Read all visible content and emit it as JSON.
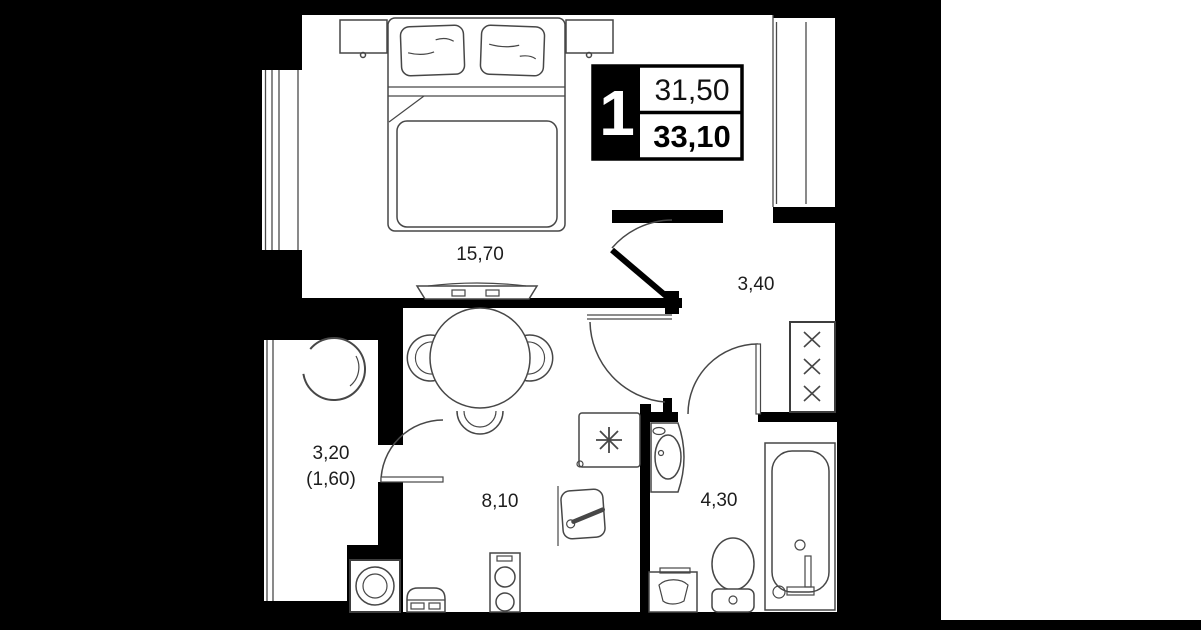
{
  "legend": {
    "room_count": "1",
    "living_area": "31,50",
    "total_area": "33,10"
  },
  "rooms": {
    "bedroom": "15,70",
    "hallway": "3,40",
    "kitchen": "8,10",
    "bathroom": "4,30",
    "balcony": "3,20",
    "balcony_reduced": "(1,60)"
  },
  "icons": {
    "fridge": "snowflake-icon",
    "wardrobe": "cross-hanger-icon"
  },
  "colors": {
    "background": "#000000",
    "floor": "#ffffff",
    "right_margin": "#ffffff",
    "furniture_line": "#474747"
  }
}
